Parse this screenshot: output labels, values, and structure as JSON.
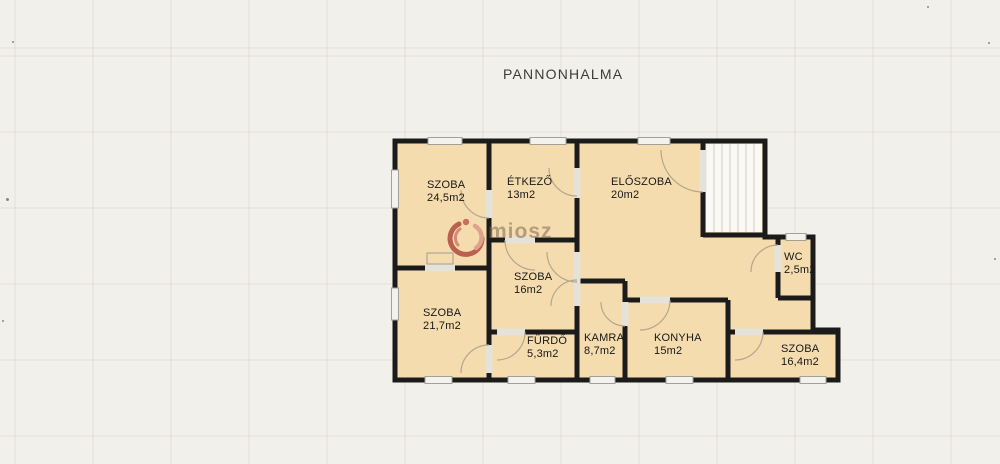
{
  "title": "PANNONHALMA",
  "watermark": {
    "text": "miosz",
    "icon": "miosz-logo-icon",
    "icon_color_dark": "#ae4038",
    "icon_color_light": "#dd9486"
  },
  "plan": {
    "wall_color": "#1b1b1b",
    "floor_color": "#f4dcae",
    "background_color": "#f2f0ea",
    "features": [
      "staircase-top-right"
    ],
    "rooms": [
      {
        "name": "SZOBA",
        "area": "24,5m2"
      },
      {
        "name": "ÉTKEZŐ",
        "area": "13m2"
      },
      {
        "name": "ELŐSZOBA",
        "area": "20m2"
      },
      {
        "name": "WC",
        "area": "2,5m2"
      },
      {
        "name": "SZOBA",
        "area": "16m2"
      },
      {
        "name": "SZOBA",
        "area": "21,7m2"
      },
      {
        "name": "FÜRDŐ",
        "area": "5,3m2"
      },
      {
        "name": "KAMRA",
        "area": "8,7m2"
      },
      {
        "name": "KONYHA",
        "area": "15m2"
      },
      {
        "name": "SZOBA",
        "area": "16,4m2"
      }
    ]
  }
}
